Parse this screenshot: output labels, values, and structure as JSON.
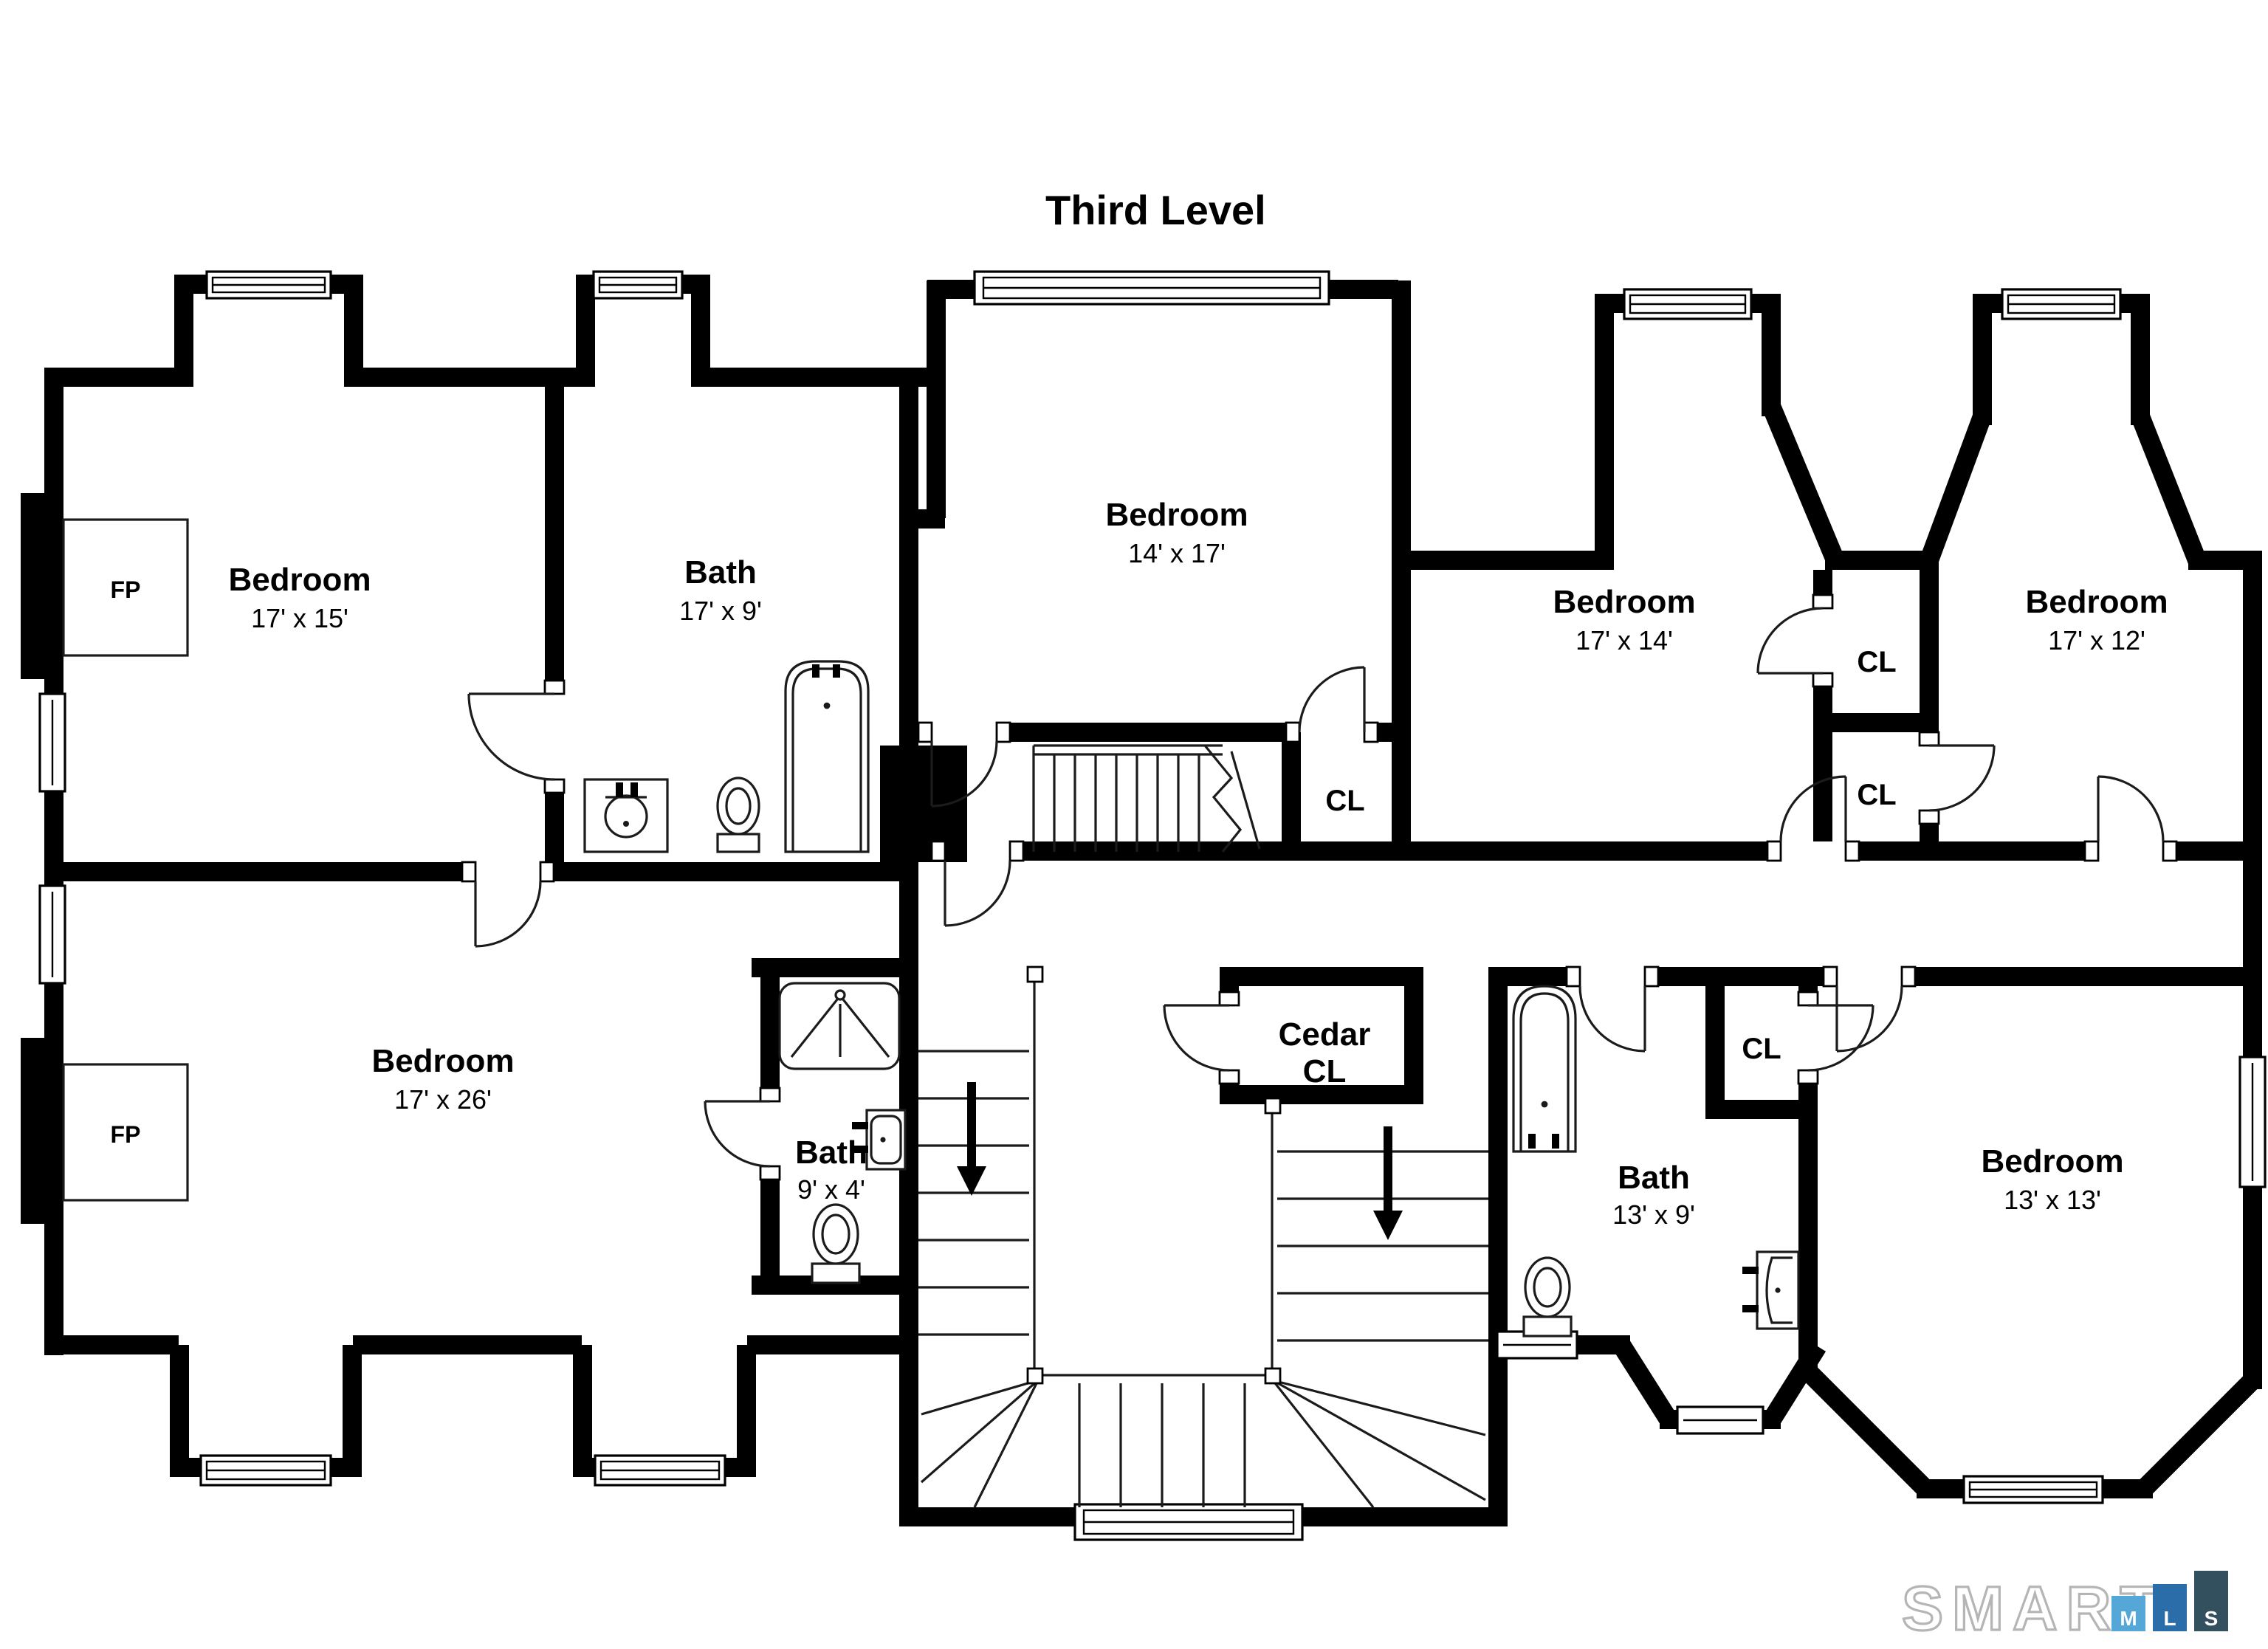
{
  "title": "Third Level",
  "rooms": {
    "bedroom_tl": {
      "name": "Bedroom",
      "dims": "17' x 15'"
    },
    "bath_top": {
      "name": "Bath",
      "dims": "17' x 9'"
    },
    "bedroom_tc": {
      "name": "Bedroom",
      "dims": "14' x 17'"
    },
    "bedroom_tr1": {
      "name": "Bedroom",
      "dims": "17' x 14'"
    },
    "bedroom_tr2": {
      "name": "Bedroom",
      "dims": "17' x 12'"
    },
    "bedroom_bl": {
      "name": "Bedroom",
      "dims": "17' x 26'"
    },
    "bath_small": {
      "name": "Bath",
      "dims": "9' x 4'"
    },
    "cedar_closet": {
      "line1": "Cedar",
      "line2": "CL"
    },
    "bath_br": {
      "name": "Bath",
      "dims": "13' x 9'"
    },
    "bedroom_br": {
      "name": "Bedroom",
      "dims": "13' x 13'"
    }
  },
  "labels": {
    "closet": "CL",
    "fireplace": "FP"
  },
  "logo": {
    "brand": "SMART",
    "mls": {
      "m": "M",
      "l": "L",
      "s": "S"
    },
    "colors": {
      "m_bar": "#55a7d8",
      "l_bar": "#2a6da9",
      "s_bar": "#32505e",
      "outline": "#b5b5b5"
    }
  }
}
